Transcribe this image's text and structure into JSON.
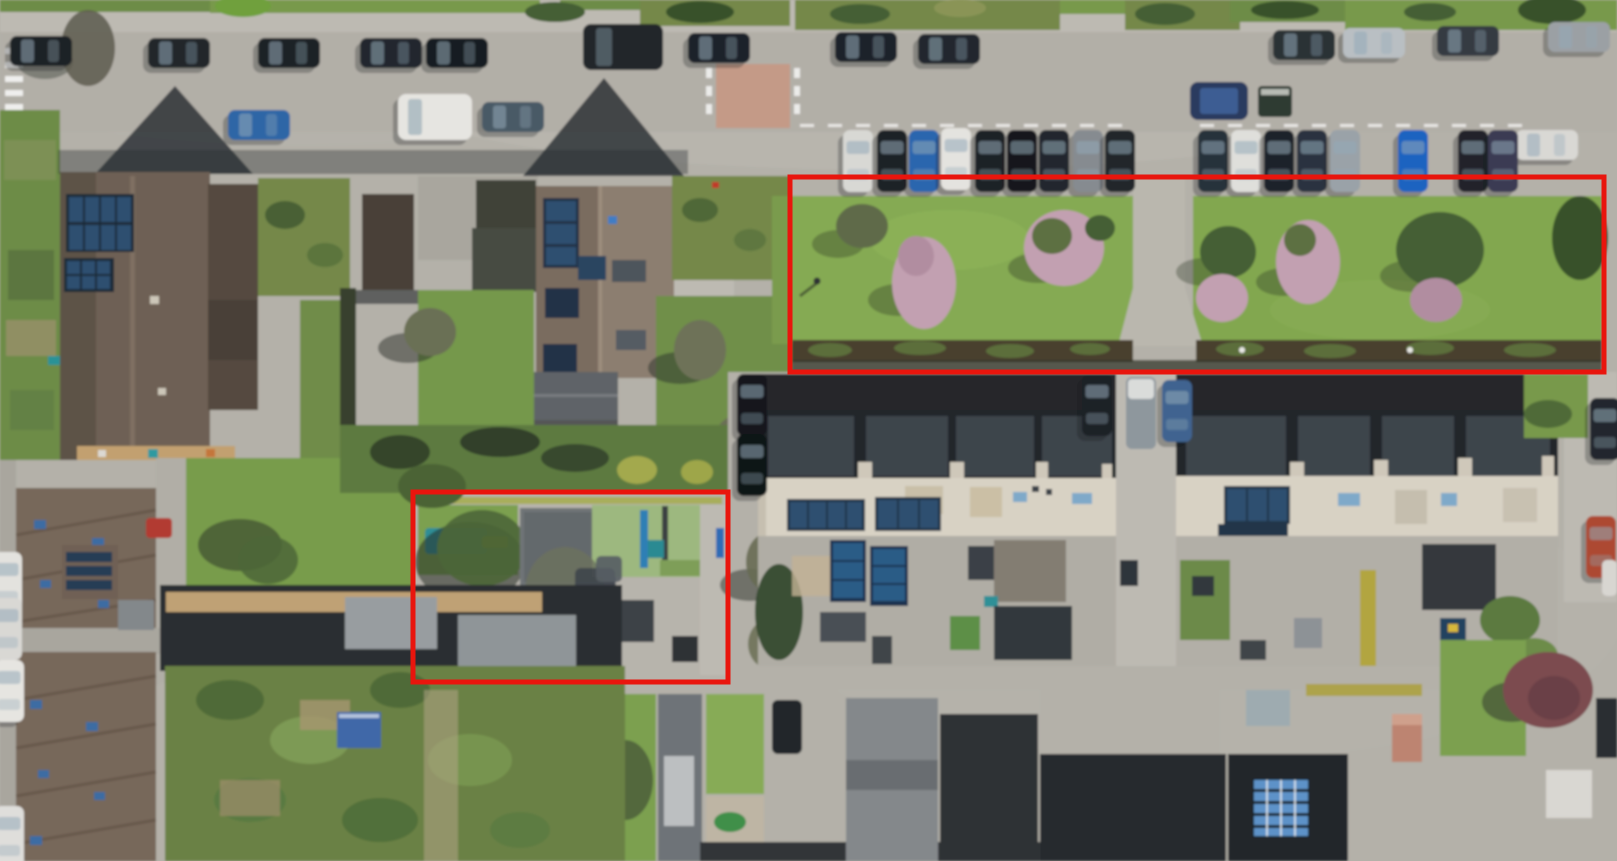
{
  "image": {
    "kind": "aerial-orthophoto",
    "title": "Aerial photograph of a residential neighbourhood with two red annotation boxes",
    "description": "Top-down aerial view of a residential block: an east-west street with parallel and perpendicular parking at the top, detached brown-roofed houses with rooftop solar panels on the left, two terraces of dark-roofed row houses with flat light roofs and solar panels on the right, communal lawns with blossoming trees, back gardens, allotments and a paved playground. Two areas are outlined with red annotation rectangles.",
    "width_px": 1617,
    "height_px": 861
  },
  "annotations": {
    "color": "#e9150d",
    "stroke_width": 5,
    "boxes": [
      {
        "id": "box-green-space",
        "label": "communal lawns with ornamental and blossoming trees, central footpath and adjoining parking strip",
        "x": 790,
        "y": 177,
        "width": 814,
        "height": 195
      },
      {
        "id": "box-playground",
        "label": "paved neighbourhood playground with play equipment",
        "x": 413,
        "y": 492,
        "width": 315,
        "height": 190
      }
    ]
  },
  "scene": {
    "regions": [
      {
        "name": "street-top",
        "description": "East-west street with parallel-parked cars on both sides, a paved pedestrian crossing and a car towing a trailer"
      },
      {
        "name": "perpendicular-parking",
        "description": "Row of perpendicular parking bays with about 18 parked cars facing the communal lawns"
      },
      {
        "name": "annotated-green-space",
        "description": "Two rectangular communal lawns with pink blossoming and dark green trees, separated by a paved path and bordered by a low hedge"
      },
      {
        "name": "terraced-houses",
        "description": "Two terraces of row houses with dark pitched roofs, light flat roof sections, rooftop solar panels, skylights and cluttered back gardens"
      },
      {
        "name": "detached-houses",
        "description": "Large detached houses with brown tiled roofs, solar panel arrays, patios and landscaped gardens"
      },
      {
        "name": "annotated-playground",
        "description": "Paved playground with teal play structures, a yellow slide, rubber mats, a climbing frame, sandpit and benches"
      },
      {
        "name": "bottom-left-roofs",
        "description": "Long brown tiled terrace roofs with blue skylights, white cars parked along the left edge, and dark flat-roofed outbuildings with grey sheds"
      },
      {
        "name": "allotments",
        "description": "Back gardens and allotments with sheds, greenhouses, a blue tarp and lawns; a reddish ornamental tree near the lower right"
      }
    ],
    "palette": {
      "pavement": "#b4b1a9",
      "street": "#b2afa7",
      "grass": "#78994c",
      "lawn": "#85aa52",
      "dark_roof": "#23272c",
      "brown_roof": "#6e6055",
      "flat_roof": "#d8d2c4",
      "solar_panel": "#2f5070",
      "hedge": "#48402f",
      "blossom": "#c2a0b1",
      "tree": "#455f35",
      "annotation_red": "#e9150d"
    }
  }
}
